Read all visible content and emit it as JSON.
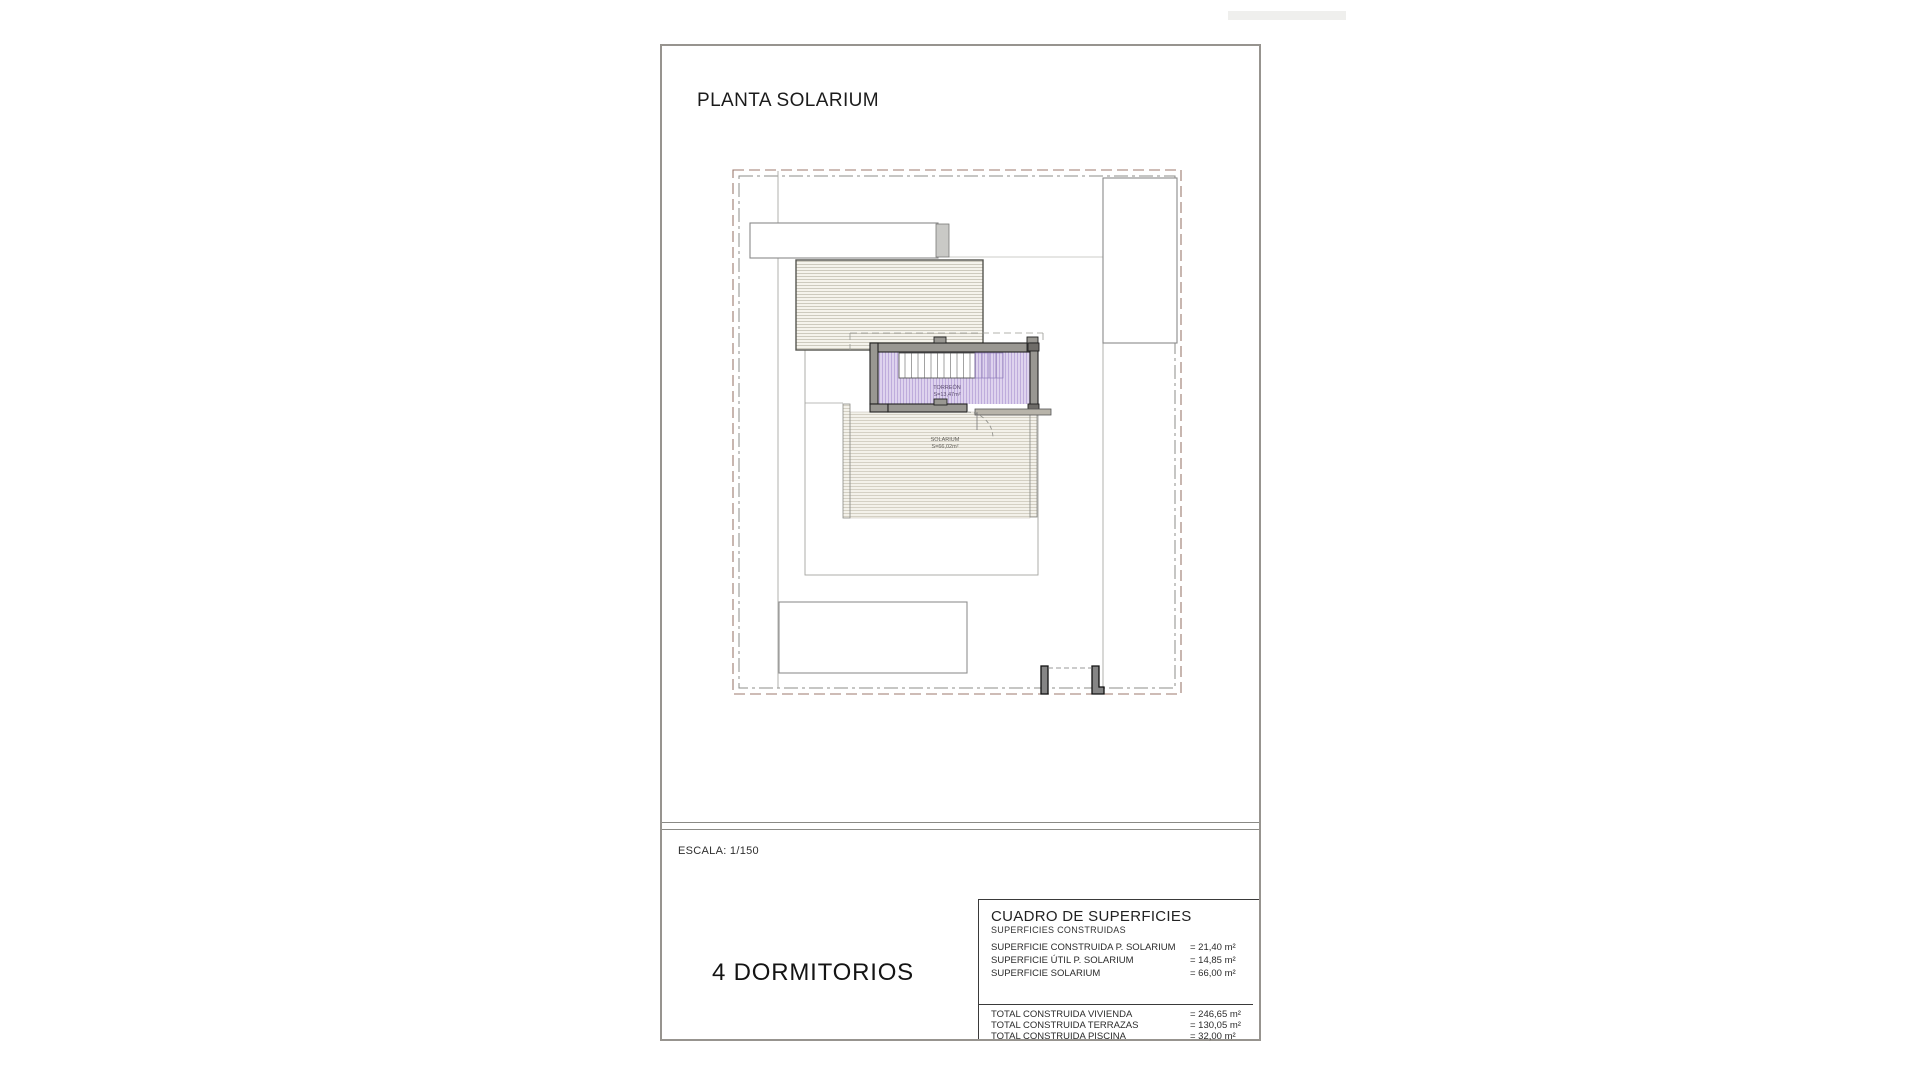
{
  "page": {
    "title": "PLANTA SOLARIUM",
    "scale_label": "ESCALA: 1/150",
    "bedrooms_label": "4 DORMITORIOS"
  },
  "plan": {
    "labels": {
      "torreon_name": "TORREÓN",
      "torreon_area": "S=13,47m²",
      "solarium_name": "SOLARIUM",
      "solarium_area": "S=66,02m²"
    }
  },
  "surface_table": {
    "title": "CUADRO DE SUPERFICIES",
    "subtitle": "SUPERFICIES CONSTRUIDAS",
    "rows": [
      {
        "label": "SUPERFICIE CONSTRUIDA P. SOLARIUM",
        "value": "= 21,40 m²"
      },
      {
        "label": "SUPERFICIE ÚTIL P. SOLARIUM",
        "value": "= 14,85 m²"
      },
      {
        "label": "SUPERFICIE SOLARIUM",
        "value": "= 66,00 m²"
      }
    ],
    "totals": [
      {
        "label": "TOTAL CONSTRUIDA VIVIENDA",
        "value": "= 246,65 m²"
      },
      {
        "label": "TOTAL CONSTRUIDA TERRAZAS",
        "value": "= 130,05 m²"
      },
      {
        "label": "TOTAL CONSTRUIDA PISCINA",
        "value": "= 32,00 m²"
      }
    ]
  }
}
